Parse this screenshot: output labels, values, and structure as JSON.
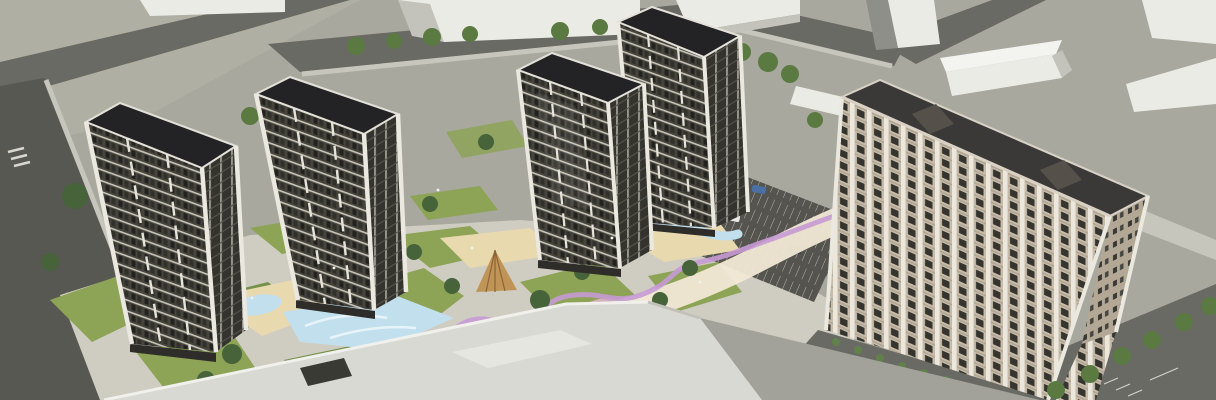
{
  "scene": {
    "type": "architectural-aerial-render",
    "subject": "residential complex masterplan visualization",
    "tower_count": 4,
    "slab_building_count": 1,
    "context_blocks": "white massing boxes",
    "features": [
      "courtyard-lawns",
      "playgrounds",
      "water-mural",
      "winding-path",
      "parking-lot",
      "street-trees"
    ]
  },
  "palette": {
    "ground": "#a8a89e",
    "groundLight": "#b4b4a9",
    "road": "#6a6a64",
    "roadDark": "#585853",
    "sidewalk": "#c6c6bc",
    "paving": "#cfccc1",
    "massingFace": "#ebebe6",
    "massingSide": "#c3c3bb",
    "massingShadow": "#8f8f89",
    "towerRoof": "#232326",
    "towerFrame": "#eae8df",
    "towerPodium": "#2e2d29",
    "slabRoof": "#3b3937",
    "slabBeige": "#c7bcaa",
    "slabBeigeDark": "#b3a895",
    "parkingAsphalt": "#55544f",
    "lawn": "#8da356",
    "lawnDark": "#74904a",
    "tree": "#5a7a42",
    "treeDark": "#466339",
    "hedge": "#61814a",
    "water": "#c2dfed",
    "waterLight": "#eaf5fa",
    "sand": "#e9d9af",
    "pathCream": "#f1e8d5",
    "pathPurple": "#c79ad4",
    "pathPink": "#e6b4cc",
    "orange": "#dd8a45",
    "woodBrown": "#c09457",
    "carBlue": "#4a6fa5",
    "carDark": "#3a3f48",
    "carWhite": "#e8e8e6",
    "podiumLight": "#d9d9d3",
    "podiumGray": "#a2a29b",
    "lamp": "#f2f2ec"
  }
}
